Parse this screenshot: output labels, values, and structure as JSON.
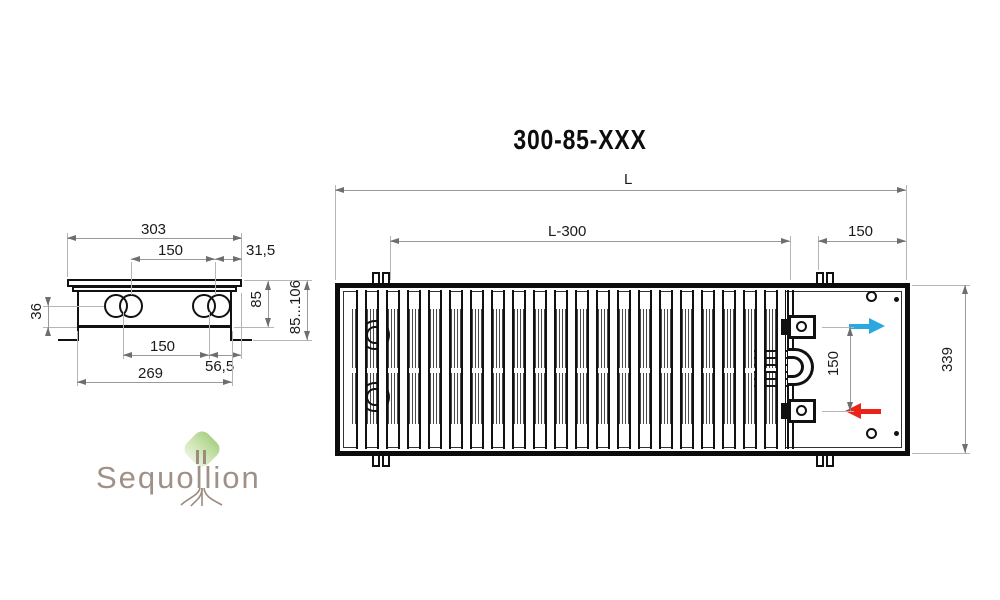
{
  "title": "300-85-XXX",
  "side_view": {
    "dim_top_width": "303",
    "dim_pipe_span_top": "150",
    "dim_edge_offset": "31,5",
    "dim_pipe_to_bottom": "36",
    "dim_body_height": "85",
    "dim_mount_height_range": "85...106",
    "dim_pipe_span_bottom": "150",
    "dim_bottom_offset": "56,5",
    "dim_body_width": "269"
  },
  "top_view": {
    "dim_total_length": "L",
    "dim_grille_length": "L-300",
    "dim_end_section": "150",
    "dim_connection_span": "150",
    "dim_width": "339"
  },
  "watermark": {
    "brand": "Sequollion"
  },
  "colors": {
    "supply_arrow_blue": "#2aa9e0",
    "return_arrow_red": "#ec2418",
    "logo_crown_green": "#a9d185",
    "logo_text_brown": "#9b8b80",
    "drawing_line": "#111111",
    "dimension_line": "#9a9a9a"
  }
}
